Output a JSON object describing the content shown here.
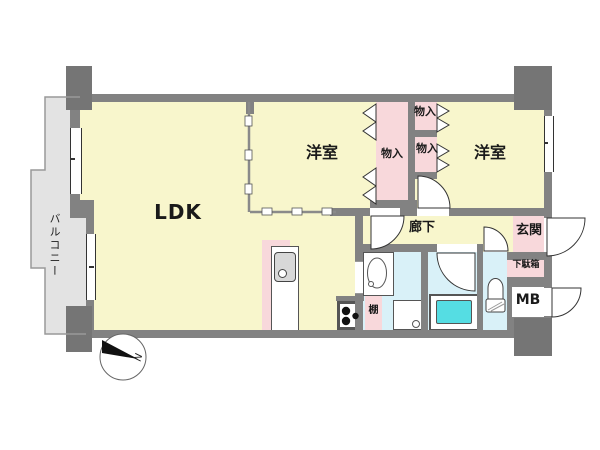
{
  "floorplan": {
    "labels": {
      "balcony": "バルコニー",
      "ldk": "LDK",
      "bedroom_center": "洋室",
      "bedroom_right": "洋室",
      "closet_a": "物入",
      "closet_b1": "物入",
      "closet_b2": "物入",
      "hallway": "廊下",
      "entrance": "玄関",
      "shoe_cabinet": "下駄箱",
      "meter_box": "MB",
      "shelf": "棚",
      "compass_north": "N"
    },
    "colors": {
      "wall_gray": "#828282",
      "pillar_gray": "#757575",
      "room_yellow": "#f8f6cc",
      "closet_pink": "#f8d8db",
      "wet_area_blue": "#d9f1f8",
      "bathtub_cyan": "#55dde3",
      "balcony_gray": "#e3e3e3"
    }
  }
}
